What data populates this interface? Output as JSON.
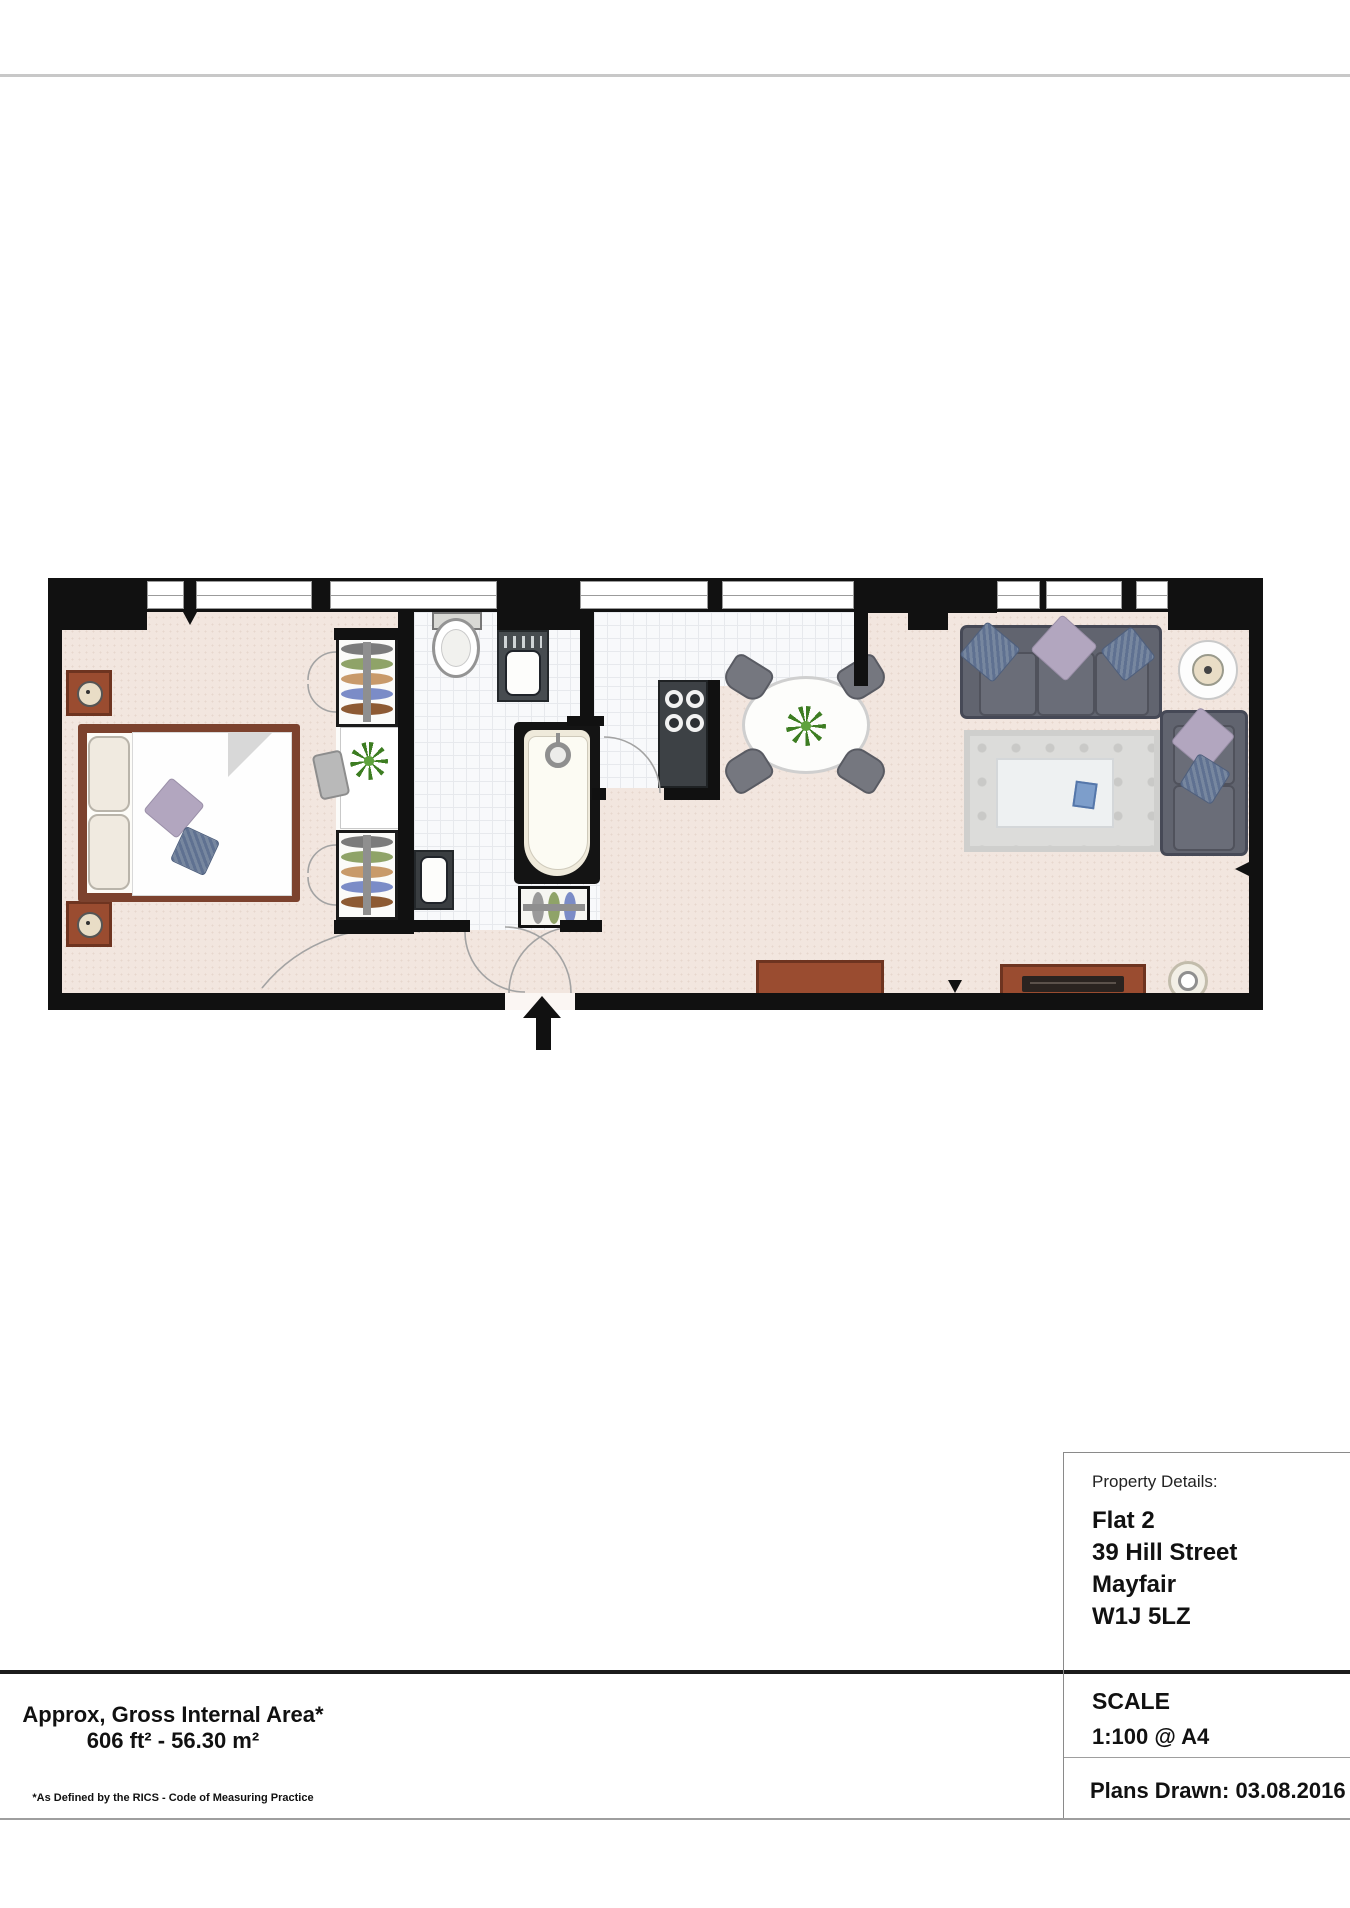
{
  "area_summary": {
    "line1": "Approx, Gross Internal Area*",
    "line2": "606 ft² - 56.30 m²",
    "footnote": "*As Defined by the RICS - Code of Measuring Practice"
  },
  "property_details": {
    "label": "Property Details:",
    "address_lines": [
      "Flat 2",
      "39 Hill Street",
      "Mayfair",
      "W1J 5LZ"
    ]
  },
  "scale_block": {
    "heading": "SCALE",
    "value": "1:100 @ A4"
  },
  "plans_drawn": {
    "text": "Plans Drawn: 03.08.2016"
  },
  "colors": {
    "wall": "#111111",
    "floor_beige": "#f2e6df",
    "tile": "#f8f9fb",
    "tile_line": "#e7e9ed",
    "brown": "#9a4c30",
    "brown_dark": "#6e3420",
    "sofa": "#61646f",
    "sofa_dark": "#464956",
    "pillow_lavender": "#b2a6bf",
    "pillow_blue": "#5f7191",
    "rug": "#dcdcda",
    "plant": "#3d7d22",
    "accent_cream": "#e9ddc6"
  }
}
